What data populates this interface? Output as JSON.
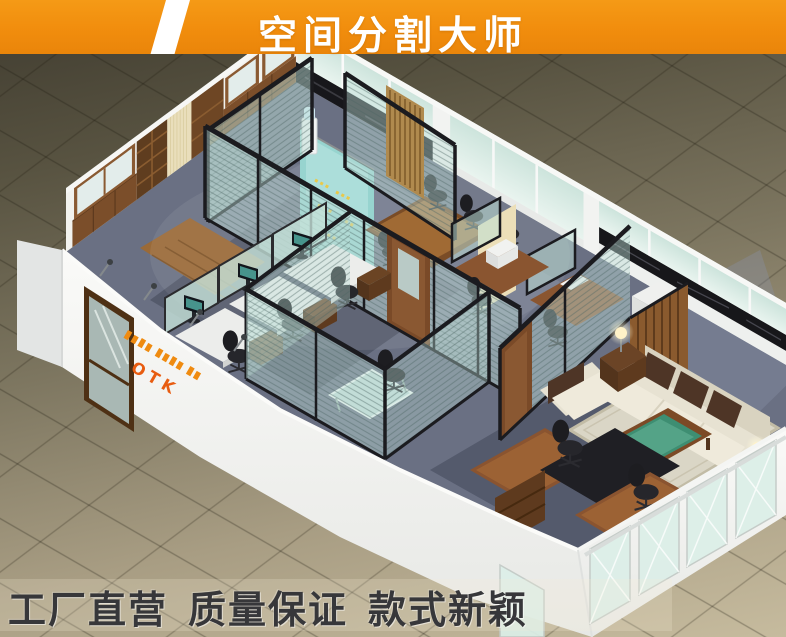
{
  "banner": {
    "title": "空间分割大师",
    "bg_color": "#F18D0D",
    "stripe_color": "#FFFFFF",
    "text_color": "#FFFFFF"
  },
  "scene": {
    "logo_wall_text": "OTK",
    "colors": {
      "floor_tile_dark": "#4A4536",
      "floor_tile_light": "#C6BB9E",
      "wall_white": "#F4F4F1",
      "partition_frame": "#1B1B1F",
      "partition_glass": "#D8ECE6",
      "wood": "#7B4E2A",
      "carpet": "#6A7083",
      "sofa_cream": "#E7E2D2",
      "sofa_cushion": "#4E3526",
      "table_glass_green": "#3E8E72",
      "logo_orange": "#EF8B10"
    }
  },
  "footer": {
    "phrases": [
      "工厂直营",
      "质量保证",
      "款式新颖"
    ],
    "text_color": "#37373A"
  }
}
